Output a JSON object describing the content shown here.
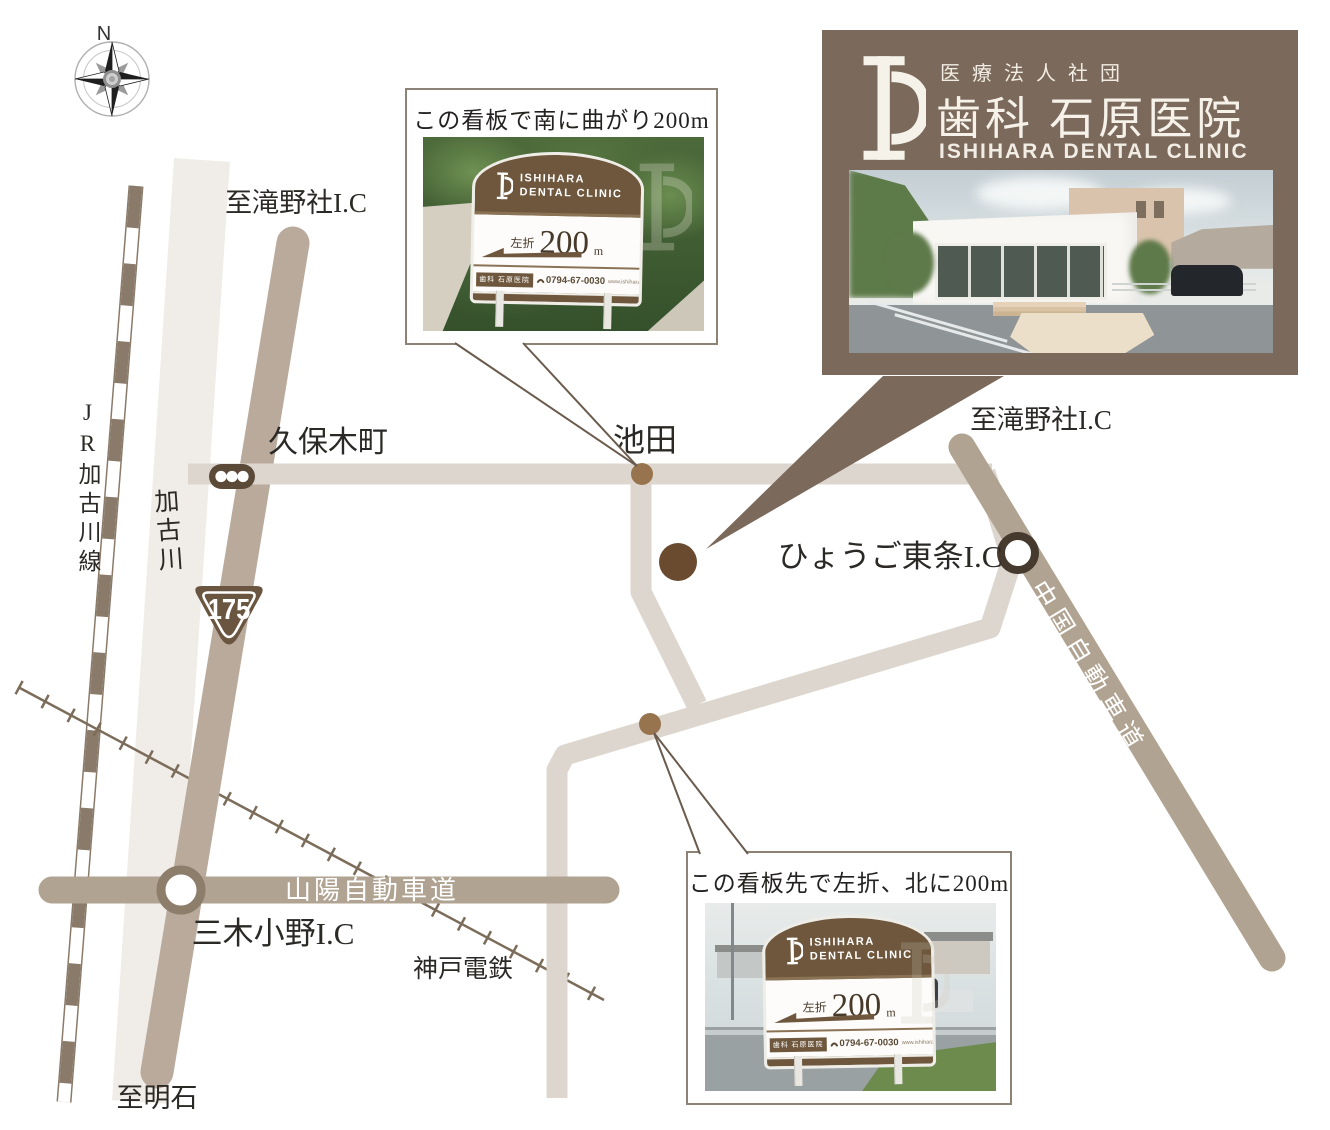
{
  "compass": {
    "north": "N"
  },
  "card": {
    "org": "医療法人社団",
    "name": "歯科 石原医院",
    "name_en": "ISHIHARA DENTAL CLINIC"
  },
  "callout_top": {
    "text": "この看板で南に曲がり200m"
  },
  "callout_bottom": {
    "text": "この看板先で左折、北に200m"
  },
  "signboard": {
    "brand1": "ISHIHARA",
    "brand2": "DENTAL CLINIC",
    "direction": "左折",
    "distance": "200",
    "unit": "m",
    "name": "歯科 石原医院",
    "phone": "0794-67-0030",
    "url": "www.ishihara-dc.com"
  },
  "labels": {
    "to_takino_left": "至滝野社I.C",
    "to_takino_right": "至滝野社I.C",
    "kuboki": "久保木町",
    "ikeda": "池田",
    "hyogo_tojo": "ひょうご東条I.C",
    "chugoku": "中国自動車道",
    "sanyo": "山陽自動車道",
    "miki_ono": "三木小野I.C",
    "kobe_rail": "神戸電鉄",
    "to_akashi": "至明石",
    "jr_line": "JR加古川線",
    "river": "加古川",
    "route": "175"
  },
  "colors": {
    "road_light": "#ddd6ce",
    "road_mid": "#b9aa9c",
    "highway": "#b1a391",
    "river": "#f0ece7",
    "rail_brown": "#8a7a69",
    "card_bg": "#7b695b",
    "sign_brown": "#6e573d",
    "dot_clinic": "#6a4b30",
    "dot_mid": "#97744e",
    "label_text": "#2b2926"
  }
}
